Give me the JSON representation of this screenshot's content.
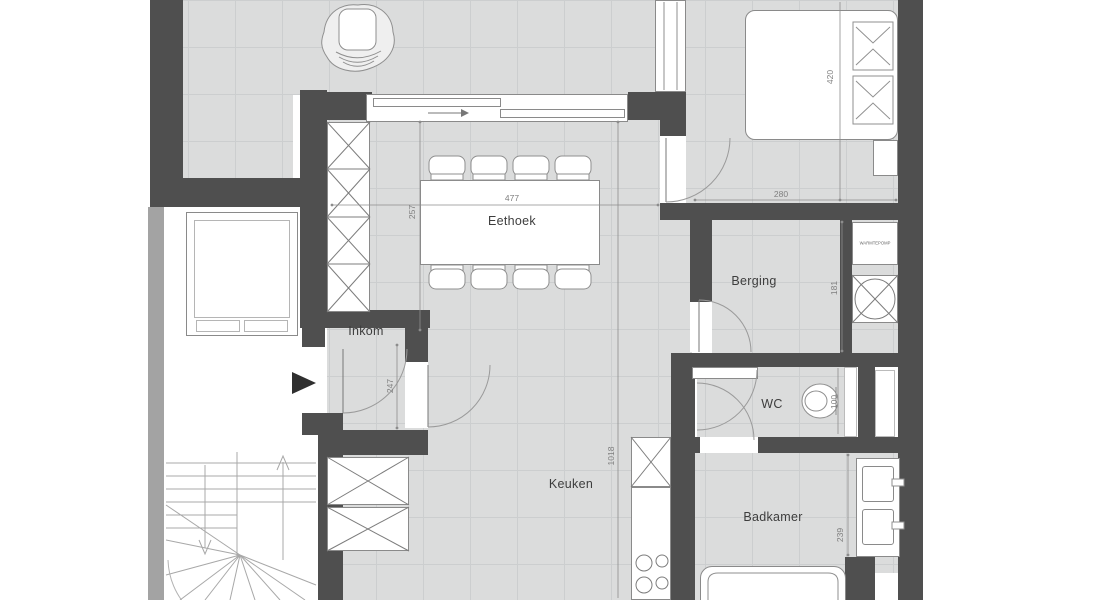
{
  "plan_title": "Floor plan apartment level",
  "rooms": {
    "eethoek": "Eethoek",
    "inkom": "Inkom",
    "berging": "Berging",
    "wc": "WC",
    "keuken": "Keuken",
    "badkamer": "Badkamer"
  },
  "appliances": {
    "warmtepomp": "WARMTEPOMP"
  },
  "dimensions": {
    "dining_width": "477",
    "dining_depth": "257",
    "bedroom_width": "280",
    "bedroom_depth": "420",
    "berging_depth": "181",
    "inkom_depth": "247",
    "plan_length": "1018",
    "wc_width": "100",
    "badkamer_depth": "239"
  },
  "colors": {
    "wall": "#4f4f4f",
    "floor": "#dbdcdc",
    "grid": "#cccecf",
    "stroke": "#8a8a8a",
    "dim_text": "#7f7f7f",
    "room_text": "#3d3d3d",
    "band": "#a3a3a3",
    "arrow": "#2f2f2f"
  }
}
